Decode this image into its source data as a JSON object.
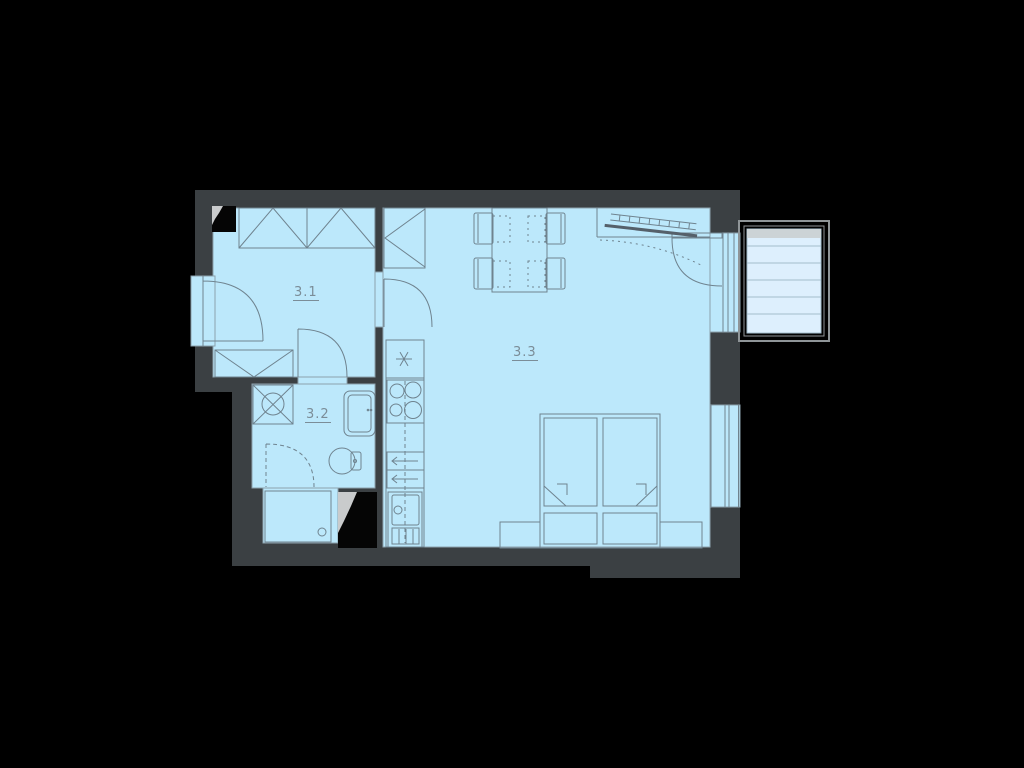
{
  "plan": {
    "rooms": [
      {
        "number": "3.1"
      },
      {
        "number": "3.2"
      },
      {
        "number": "3.3"
      }
    ],
    "colors": {
      "background": "#000000",
      "wall": "#3b4043",
      "floor": "#bce8fb",
      "outline": "#8ca2ae",
      "line": "#6f838f",
      "label": "#7b8d98",
      "deck": "#ddeffd",
      "deck_line": "#a2bccb",
      "threshold": "#ccd3d6",
      "balcony_frame": "#8f9598",
      "shaft": "#050505",
      "shaft_wedge": "#c9cbcc"
    },
    "symbols": [
      "entrance-door",
      "interior-door",
      "balcony-door",
      "tilt-swing",
      "window",
      "wardrobe",
      "tall-cabinet",
      "fridge-freezer",
      "cooktop",
      "drawer-unit",
      "kitchen-sink",
      "washing-machine",
      "washbasin",
      "toilet",
      "shower-tray",
      "shower-door",
      "duct-shaft",
      "dining-table",
      "chair",
      "double-bed",
      "nightstand",
      "pillow",
      "radiator",
      "balcony-deck"
    ]
  }
}
